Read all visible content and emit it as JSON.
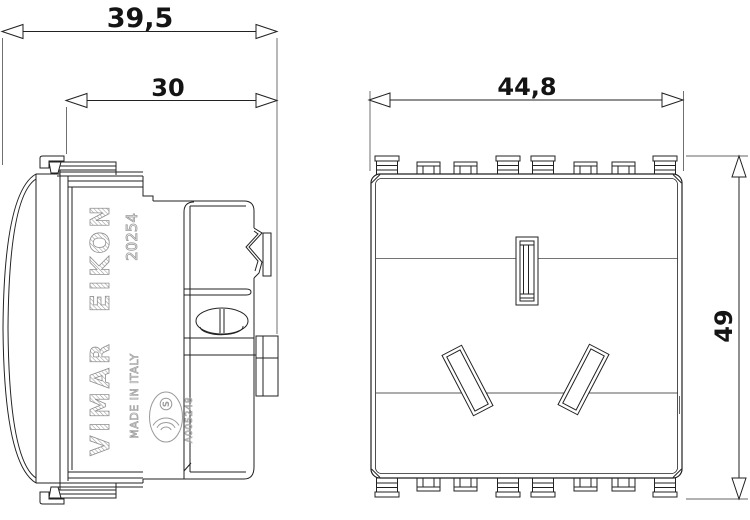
{
  "drawing": {
    "dimensions": {
      "total_depth": "39,5",
      "body_depth": "30",
      "front_width": "44,8",
      "front_height": "49"
    },
    "markings": {
      "series": "EIKON",
      "article": "20254",
      "brand": "VIMAR",
      "origin": "MADE IN ITALY",
      "approval": "A005248",
      "cert_letter": "S"
    },
    "colors": {
      "line": "#222222",
      "dimension_text": "#141414",
      "molded_text": "#9a9a9a",
      "background": "#ffffff"
    }
  }
}
